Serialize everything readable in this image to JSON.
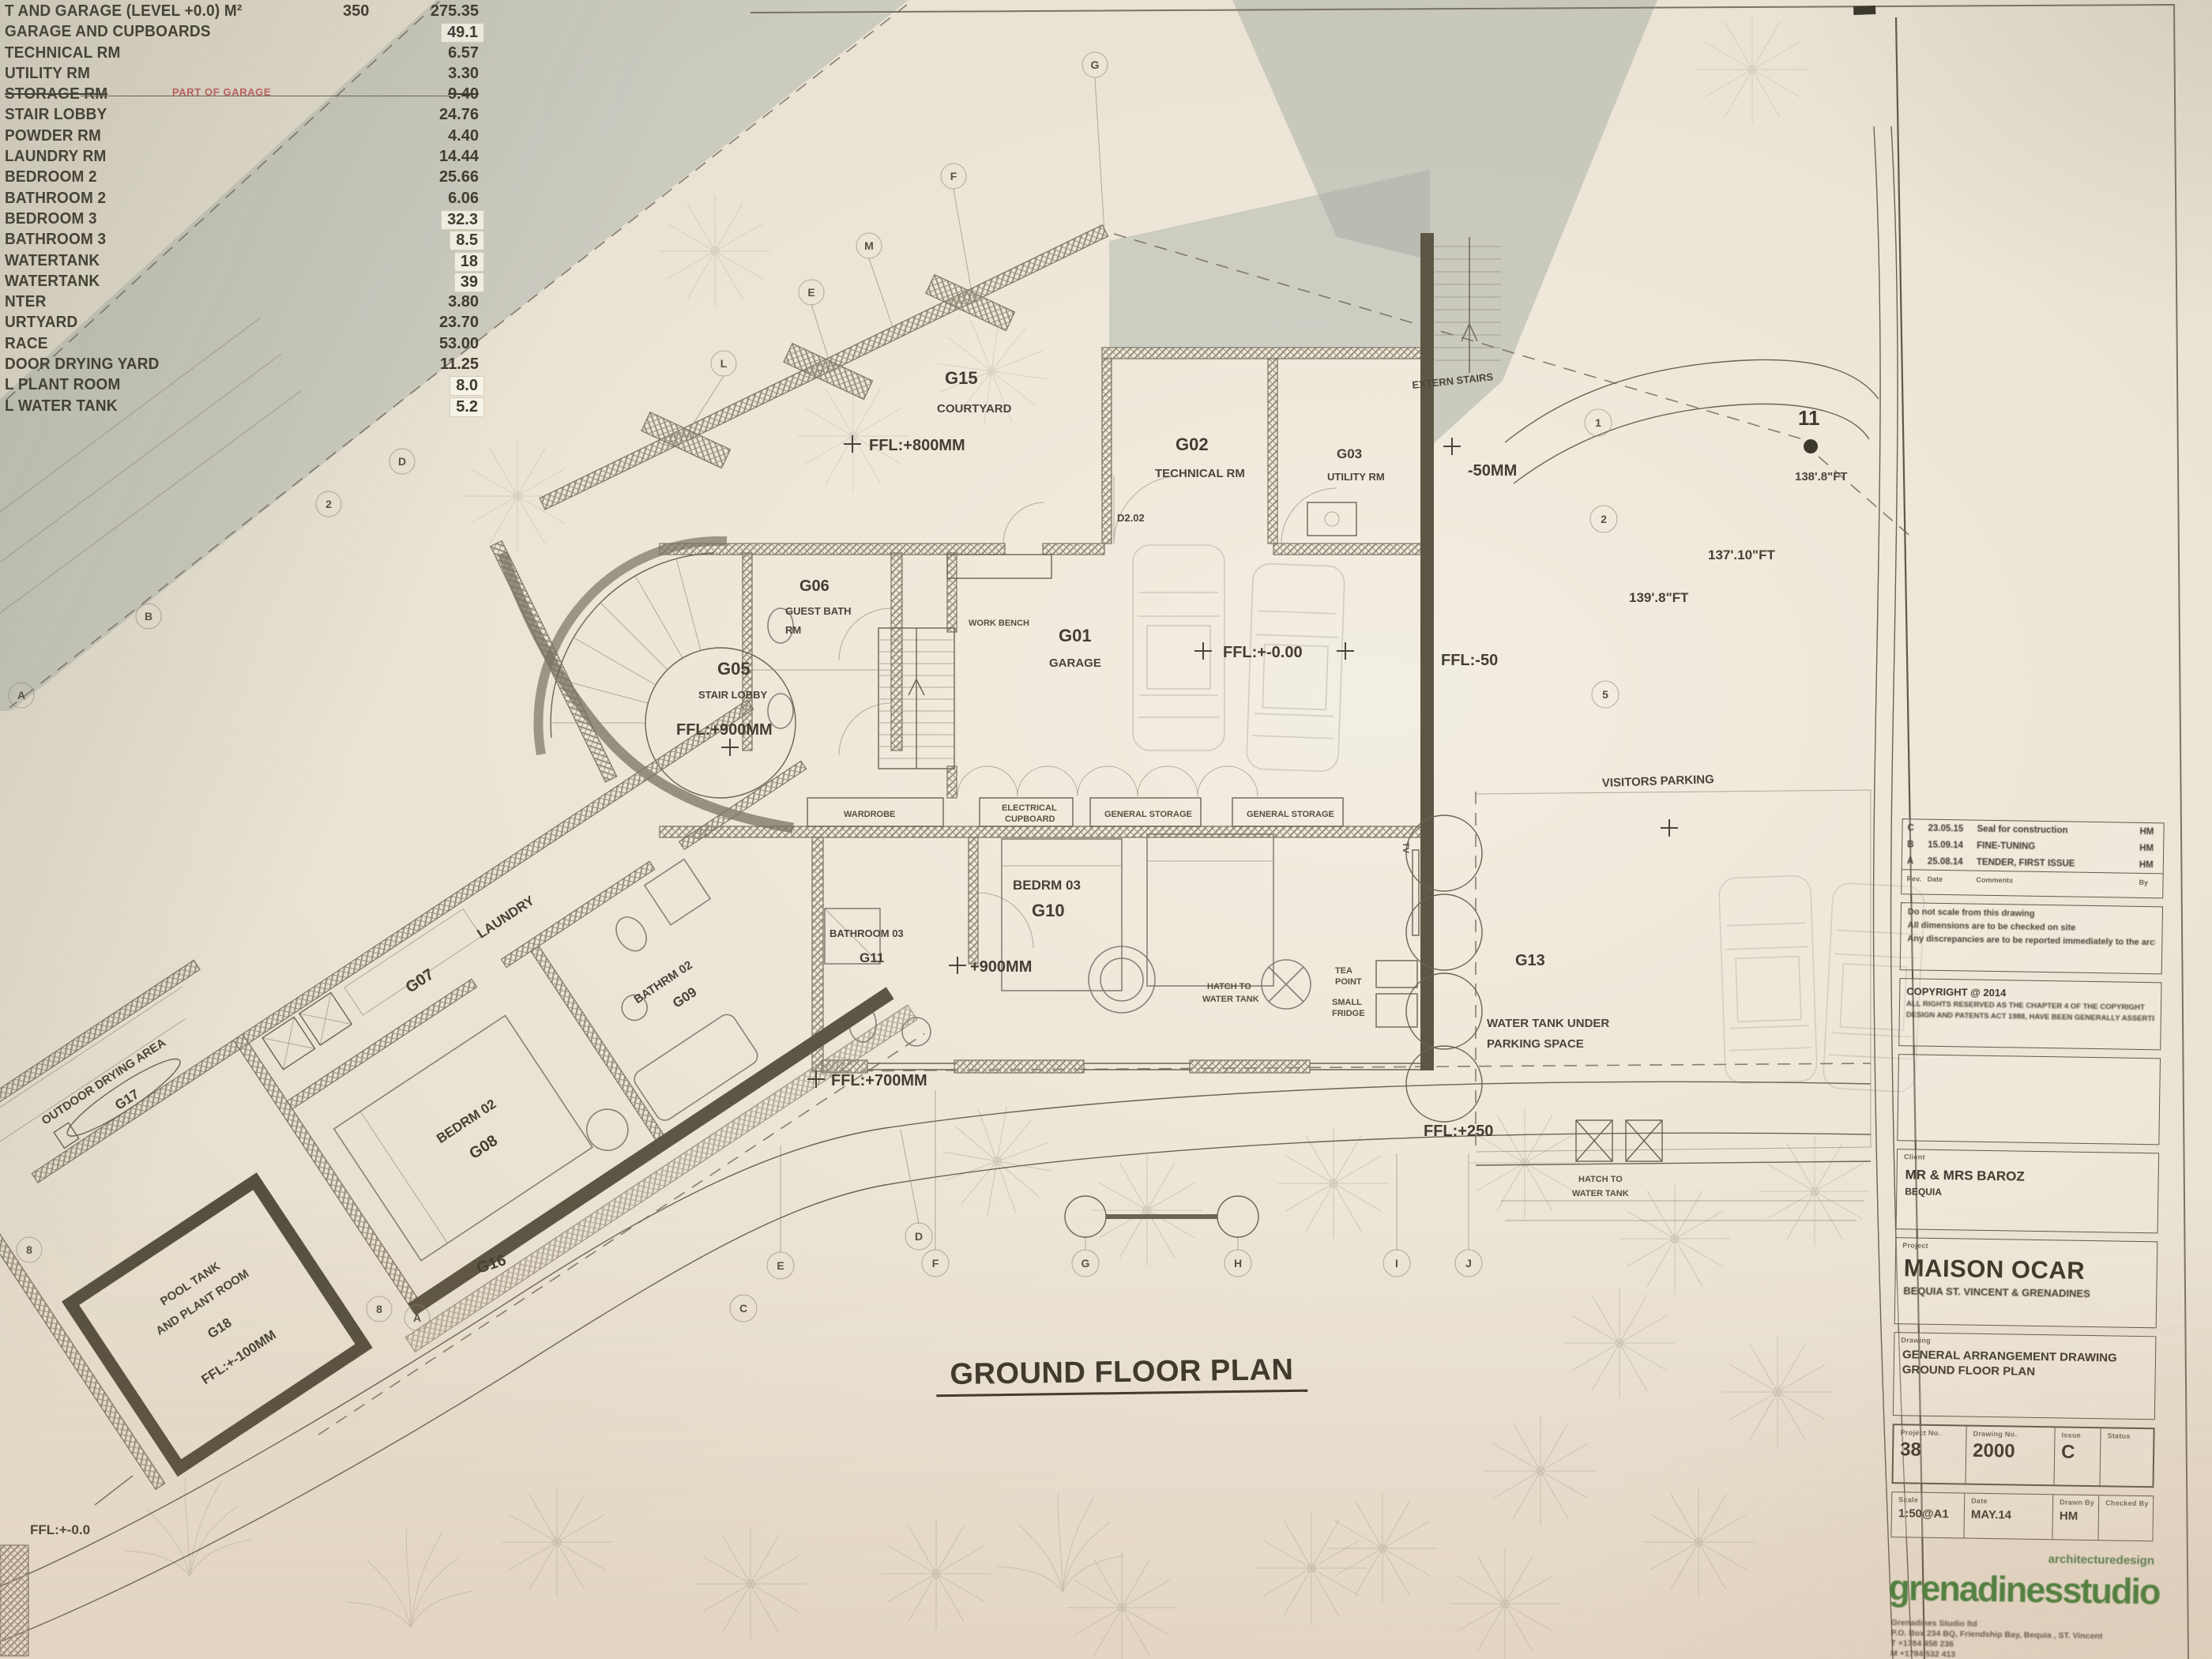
{
  "schedule": {
    "rows": [
      {
        "name": "T AND GARAGE (LEVEL +0.0) M²",
        "mid": "350",
        "value": "275.35"
      },
      {
        "name": "GARAGE AND CUPBOARDS",
        "value": "49.1"
      },
      {
        "name": "TECHNICAL RM",
        "value": "6.57"
      },
      {
        "name": "UTILITY RM",
        "value": "3.30"
      },
      {
        "name": "STORAGE RM",
        "note": "PART OF GARAGE",
        "value": "9.40"
      },
      {
        "name": "STAIR LOBBY",
        "value": "24.76"
      },
      {
        "name": "POWDER RM",
        "value": "4.40"
      },
      {
        "name": "LAUNDRY RM",
        "value": "14.44"
      },
      {
        "name": "BEDROOM 2",
        "value": "25.66"
      },
      {
        "name": "BATHROOM 2",
        "value": "6.06"
      },
      {
        "name": "BEDROOM 3",
        "value": "32.3"
      },
      {
        "name": "BATHROOM 3",
        "value": "8.5"
      },
      {
        "name": "WATERTANK",
        "value": "18"
      },
      {
        "name": "WATERTANK",
        "value": "39"
      },
      {
        "name": "NTER",
        "value": "3.80"
      },
      {
        "name": "URTYARD",
        "value": "23.70"
      },
      {
        "name": "RACE",
        "value": "53.00"
      },
      {
        "name": "DOOR DRYING YARD",
        "value": "11.25"
      },
      {
        "name": "L PLANT ROOM",
        "value": "8.0"
      },
      {
        "name": "L WATER TANK",
        "value": "5.2"
      }
    ]
  },
  "plan": {
    "title": "GROUND FLOOR PLAN",
    "labels": {
      "g15_code": "G15",
      "g15_name": "COURTYARD",
      "ffl800": "FFL:+800MM",
      "g02_code": "G02",
      "g02_name": "TECHNICAL RM",
      "d202": "D2.02",
      "g03_code": "G03",
      "g03_name": "UTILITY RM",
      "minus50": "-50MM",
      "extern": "EXTERN STAIRS",
      "g06_code": "G06",
      "g06_name1": "GUEST BATH",
      "g06_name2": "RM",
      "workbench": "WORK BENCH",
      "g01_code": "G01",
      "g01_name": "GARAGE",
      "ffl000": "FFL:+-0.00",
      "ffl50": "FFL:-50",
      "g05_code": "G05",
      "g05_name": "STAIR LOBBY",
      "ffl900": "FFL:+900MM",
      "wardrobe": "WARDROBE",
      "elec1": "ELECTRICAL",
      "elec2": "CUPBOARD",
      "gs1": "GENERAL STORAGE",
      "gs2": "GENERAL STORAGE",
      "g10_name": "BEDRM 03",
      "g10_code": "G10",
      "plus900": "+900MM",
      "g11_name": "BATHROOM 03",
      "g11_code": "G11",
      "hatch1a": "HATCH TO",
      "hatch1b": "WATER TANK",
      "tea1": "TEA",
      "tea2": "POINT",
      "fr1": "SMALL",
      "fr2": "FRIDGE",
      "tv": "TV",
      "g13_code": "G13",
      "g13a": "WATER TANK UNDER",
      "g13b": "PARKING SPACE",
      "visitors": "VISITORS PARKING",
      "ffl250": "FFL:+250",
      "hatch2a": "HATCH TO",
      "hatch2b": "WATER TANK",
      "g07_code": "G07",
      "g07_name": "LAUNDRY",
      "g08_name": "BEDRM 02",
      "g08_code": "G08",
      "g09_name": "BATHRM 02",
      "g09_code": "G09",
      "g17_name": "OUTDOOR DRYING AREA",
      "g17_code": "G17",
      "g18a": "POOL TANK",
      "g18b": "AND PLANT ROOM",
      "g18_code": "G18",
      "g18c": "FFL:+-100MM",
      "g16": "G16",
      "ffl700": "FFL:+700MM",
      "ffl00": "FFL:+-0.0",
      "dim11": "11",
      "dim138": "138'.8\"FT",
      "dim137": "137'.10\"FT",
      "dim139": "139'.8\"FT"
    },
    "grid": {
      "diag": [
        "L",
        "E",
        "M",
        "F",
        "G"
      ],
      "left": [
        "D",
        "2",
        "B",
        "A"
      ],
      "right": [
        "1",
        "2",
        "5"
      ],
      "bottom": [
        "C",
        "E",
        "D",
        "F",
        "G",
        "H",
        "I",
        "J"
      ],
      "corner": [
        "8",
        "8",
        "A"
      ]
    }
  },
  "titleblock": {
    "revisions": [
      {
        "rev": "C",
        "date": "23.05.15",
        "comment": "Seal for construction",
        "by": "HM"
      },
      {
        "rev": "B",
        "date": "15.09.14",
        "comment": "FINE-TUNING",
        "by": "HM"
      },
      {
        "rev": "A",
        "date": "25.08.14",
        "comment": "TENDER, FIRST ISSUE",
        "by": "HM"
      }
    ],
    "rev_headers": {
      "rev": "Rev.",
      "date": "Date",
      "comment": "Comments",
      "by": "By"
    },
    "notes": [
      "Do not scale from this drawing",
      "All dimensions are to be checked on site",
      "Any discrepancies are to be reported immediately to the architect or this Document"
    ],
    "copyright_title": "COPYRIGHT @  2014",
    "copyright_lines": [
      "ALL RIGHTS RESERVED AS THE CHAPTER 4 OF THE COPYRIGHT",
      "DESIGN AND PATENTS ACT 1988, HAVE BEEN GENERALLY ASSERTED"
    ],
    "client_label": "Client",
    "client_name": "MR & MRS BAROZ",
    "client_location": "BEQUIA",
    "project_label": "Project",
    "project_name": "MAISON OCAR",
    "project_location": "BEQUIA ST. VINCENT & GRENADINES",
    "drawing_label": "Drawing",
    "drawing_line1": "GENERAL ARRANGEMENT DRAWING",
    "drawing_line2": "GROUND FLOOR PLAN",
    "meta1_headers": [
      "Project No.",
      "Drawing No.",
      "Issue",
      "Status"
    ],
    "meta1_values": [
      "38",
      "2000",
      "C",
      ""
    ],
    "meta2_headers": [
      "Scale",
      "Date",
      "Drawn By",
      "Checked By"
    ],
    "meta2_values": [
      "1:50@A1",
      "MAY.14",
      "HM",
      ""
    ],
    "brand_top": "architecturedesign",
    "brand_name": "grenadinesstudio",
    "address_lines": [
      "Grenadines Studio ltd",
      "P.O. Box 234 BQ, Friendship Bay, Bequia , ST. Vincent",
      "T  +1784 458 236",
      "M +1784 532 413",
      "Email: grenadines@grenadinesstudio.com"
    ]
  }
}
